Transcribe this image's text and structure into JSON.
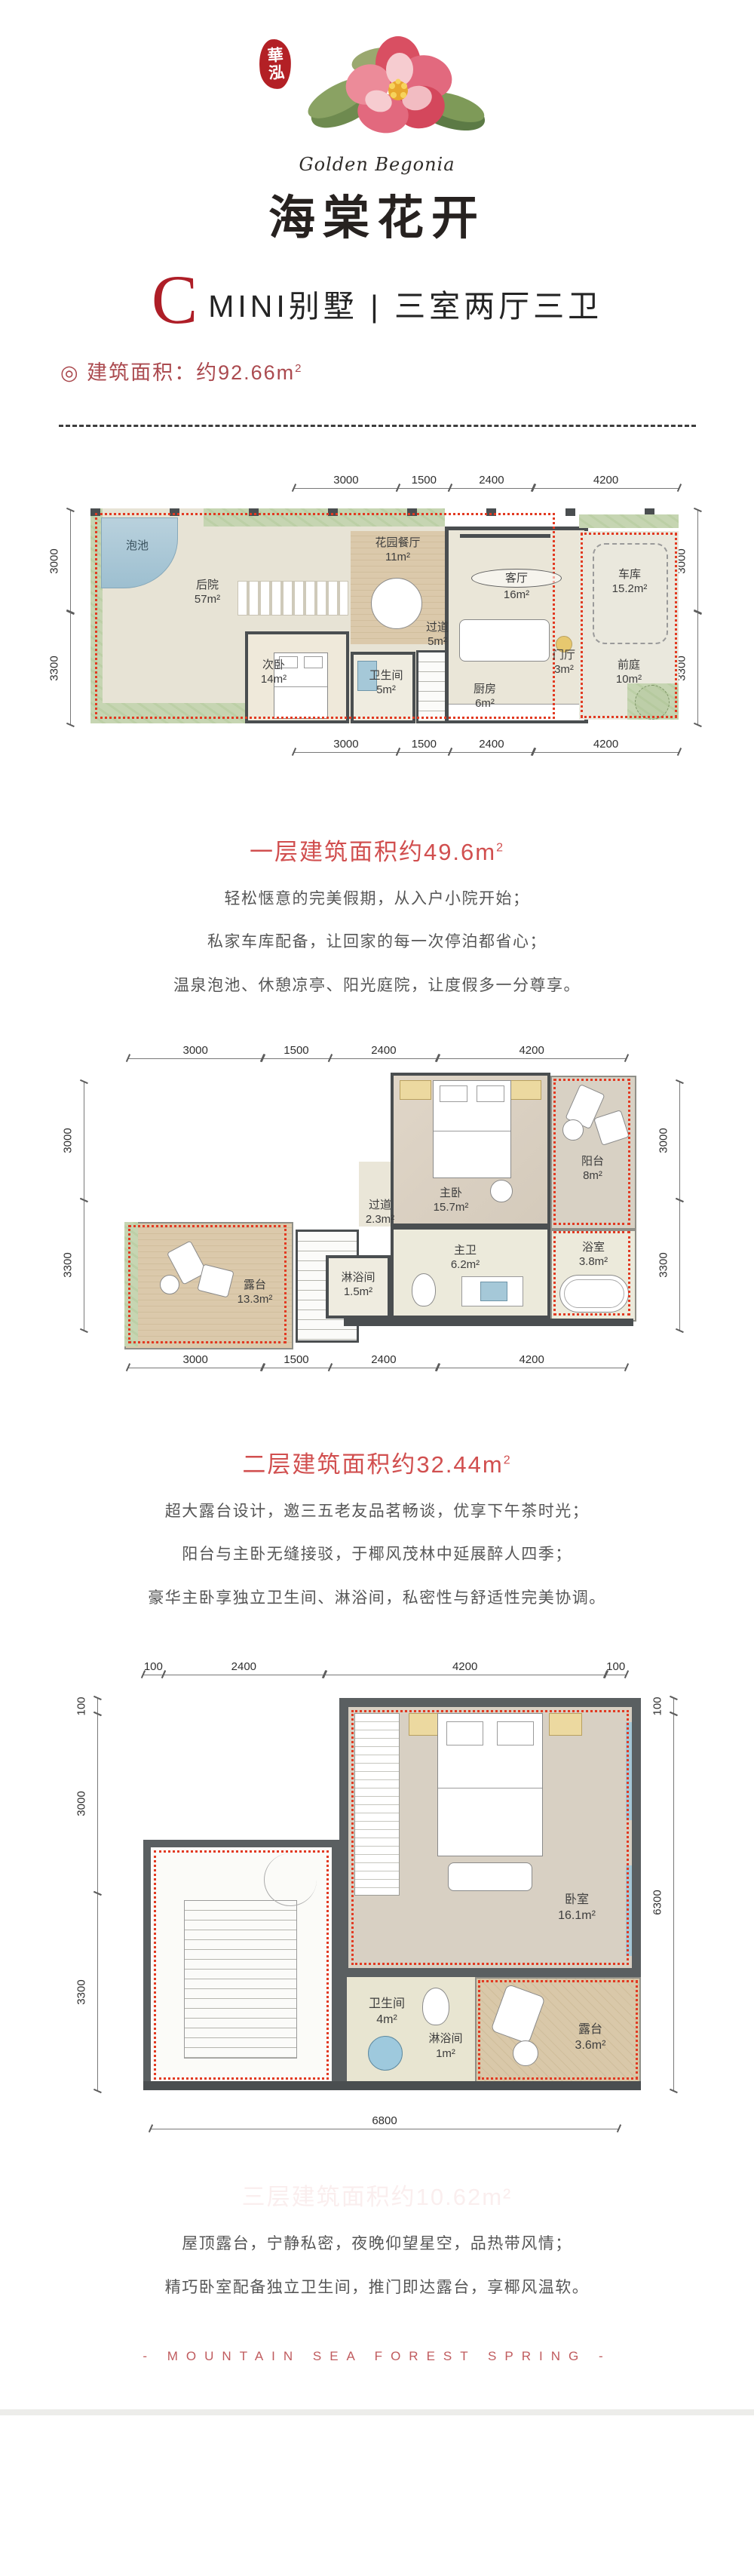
{
  "brand": {
    "seal": "華泓",
    "name_en": "Golden Begonia",
    "name_cn": "海棠花开"
  },
  "header": {
    "unit_letter": "C",
    "unit_rest": "MINI别墅 | 三室两厅三卫",
    "area_bullet": "◎",
    "area_label": "建筑面积：约92.66m",
    "area_sup": "2"
  },
  "floor1": {
    "dims": {
      "top": [
        "3000",
        "1500",
        "2400",
        "4200"
      ],
      "bottom": [
        "3000",
        "1500",
        "2400",
        "4200"
      ],
      "left": [
        "3000",
        "3300"
      ],
      "right": [
        "3000",
        "3300"
      ]
    },
    "rooms": {
      "pool": {
        "name": "泡池",
        "area": ""
      },
      "backyard": {
        "name": "后院",
        "area": "57m²"
      },
      "garden_dining": {
        "name": "花园餐厅",
        "area": "11m²"
      },
      "second_bedroom": {
        "name": "次卧",
        "area": "14m²"
      },
      "bathroom": {
        "name": "卫生间",
        "area": "5m²"
      },
      "corridor": {
        "name": "过道",
        "area": "5m²"
      },
      "living": {
        "name": "客厅",
        "area": "16m²"
      },
      "kitchen": {
        "name": "厨房",
        "area": "6m²"
      },
      "foyer": {
        "name": "门厅",
        "area": "3m²"
      },
      "garage": {
        "name": "车库",
        "area": "15.2m²"
      },
      "front_yard": {
        "name": "前庭",
        "area": "10m²"
      }
    },
    "section": {
      "heading": "一层建筑面积约49.6m",
      "heading_sup": "2",
      "lines": [
        "轻松惬意的完美假期，从入户小院开始；",
        "私家车库配备，让回家的每一次停泊都省心；",
        "温泉泡池、休憩凉亭、阳光庭院，让度假多一分尊享。"
      ]
    }
  },
  "floor2": {
    "dims": {
      "top": [
        "3000",
        "1500",
        "2400",
        "4200"
      ],
      "bottom": [
        "3000",
        "1500",
        "2400",
        "4200"
      ],
      "left": [
        "3000",
        "3300"
      ],
      "right": [
        "3000",
        "3300"
      ]
    },
    "rooms": {
      "terrace": {
        "name": "露台",
        "area": "13.3m²"
      },
      "corridor": {
        "name": "过道",
        "area": "2.3m²"
      },
      "master_bedroom": {
        "name": "主卧",
        "area": "15.7m²"
      },
      "balcony": {
        "name": "阳台",
        "area": "8m²"
      },
      "master_bath": {
        "name": "主卫",
        "area": "6.2m²"
      },
      "bath": {
        "name": "浴室",
        "area": "3.8m²"
      },
      "shower": {
        "name": "淋浴间",
        "area": "1.5m²"
      }
    },
    "section": {
      "heading": "二层建筑面积约32.44m",
      "heading_sup": "2",
      "lines": [
        "超大露台设计，邀三五老友品茗畅谈，优享下午茶时光；",
        "阳台与主卧无缝接驳，于椰风茂林中延展醉人四季；",
        "豪华主卧享独立卫生间、淋浴间，私密性与舒适性完美协调。"
      ]
    }
  },
  "floor3": {
    "dims": {
      "top": [
        "100",
        "2400",
        "4200",
        "100"
      ],
      "left": [
        "100",
        "3000",
        "3300"
      ],
      "right": [
        "100",
        "6300"
      ],
      "bottom": [
        "6800"
      ]
    },
    "rooms": {
      "bedroom": {
        "name": "卧室",
        "area": "16.1m²"
      },
      "bathroom": {
        "name": "卫生间",
        "area": "4m²"
      },
      "shower": {
        "name": "淋浴间",
        "area": "1m²"
      },
      "terrace": {
        "name": "露台",
        "area": "3.6m²"
      }
    },
    "section": {
      "heading_ghost": "三层建筑面积约10.62m²",
      "lines": [
        "屋顶露台，宁静私密，夜晚仰望星空，品热带风情；",
        "精巧卧室配备独立卫生间，推门即达露台，享椰风温软。"
      ]
    }
  },
  "footer": {
    "tagline": "- MOUNTAIN SEA FOREST SPRING -"
  },
  "colors": {
    "accent_red": "#ae1e27",
    "heading_red": "#d14f4f",
    "maroon": "#ab4a4f",
    "wall_gray": "#4a4e50",
    "boundary_red": "#e23a22",
    "garden_green": "#c6d5b2",
    "water_blue": "#a9c8d8",
    "wood_tan": "#d8c5a4"
  }
}
